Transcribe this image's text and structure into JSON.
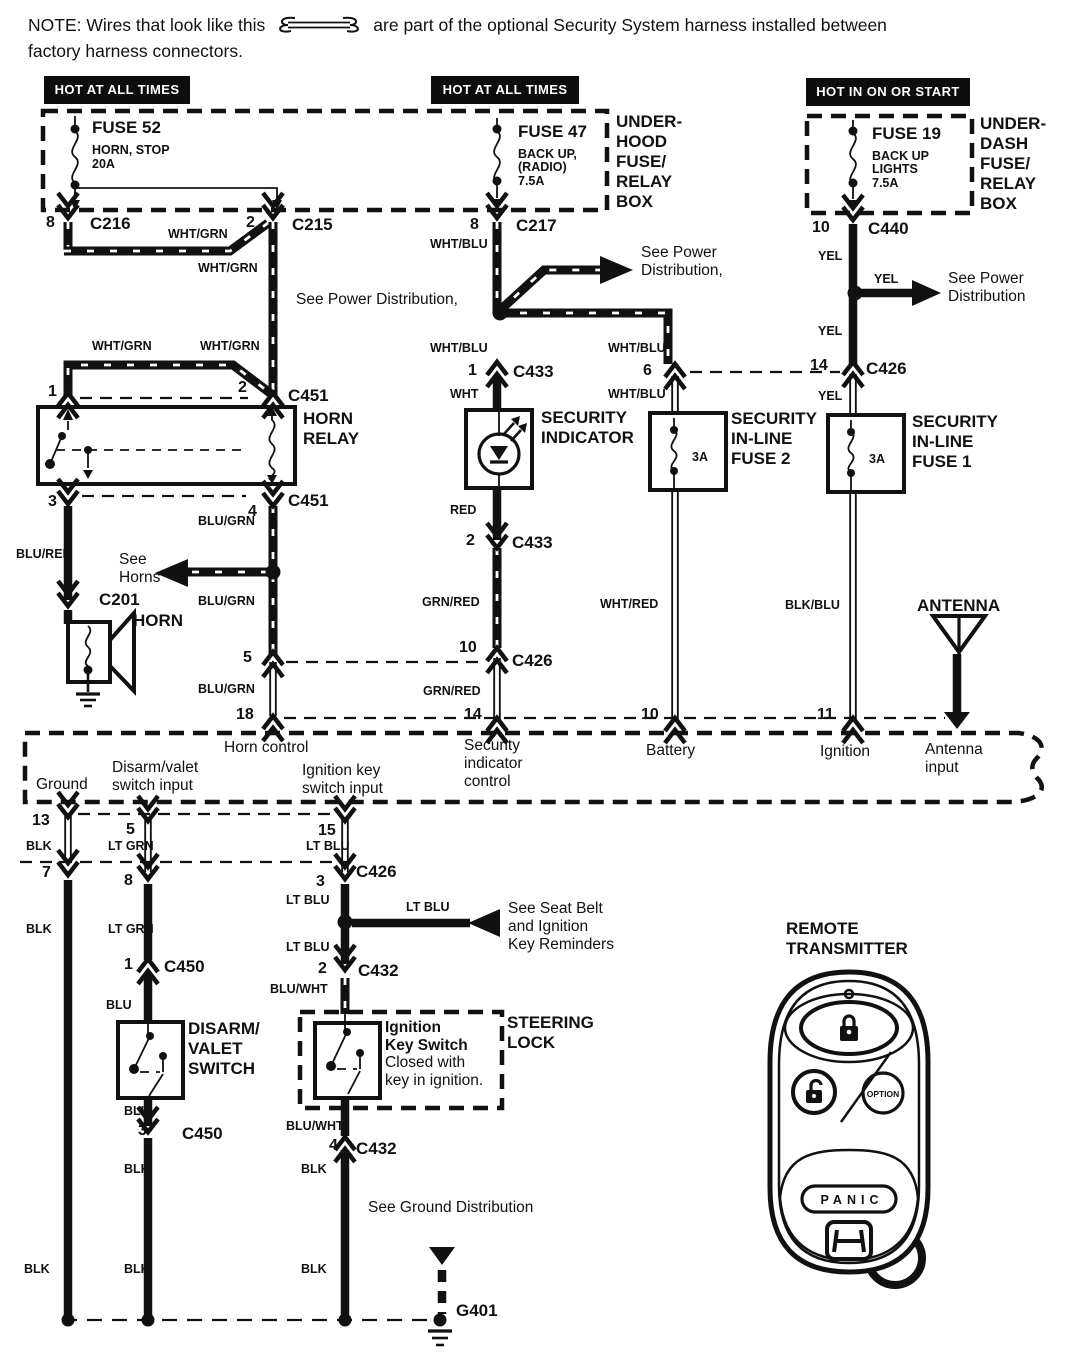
{
  "note": {
    "prefix": "NOTE: Wires that look like this",
    "suffix": "are part of the optional Security System harness installed between",
    "line2": "factory harness connectors."
  },
  "headers": {
    "left": "HOT AT ALL TIMES",
    "middle": "HOT AT ALL TIMES",
    "right": "HOT IN ON OR START"
  },
  "fuse_boxes": {
    "underhood_label": "UNDER-\nHOOD\nFUSE/\nRELAY\nBOX",
    "underdash_label": "UNDER-\nDASH\nFUSE/\nRELAY\nBOX",
    "fuse52": {
      "name": "FUSE 52",
      "desc": "HORN, STOP",
      "amp": "20A"
    },
    "fuse47": {
      "name": "FUSE 47",
      "desc1": "BACK UP,",
      "desc2": "(RADIO)",
      "amp": "7.5A"
    },
    "fuse19": {
      "name": "FUSE 19",
      "desc1": "BACK UP",
      "desc2": "LIGHTS",
      "amp": "7.5A"
    }
  },
  "components": {
    "horn_relay": "HORN\nRELAY",
    "security_indicator": "SECURITY\nINDICATOR",
    "inline_fuse2": "SECURITY\nIN-LINE\nFUSE 2",
    "inline_fuse1": "SECURITY\nIN-LINE\nFUSE 1",
    "fuse_amp_3a": "3A",
    "horn": "HORN",
    "antenna": "ANTENNA",
    "disarm_switch": "DISARM/\nVALET\nSWITCH",
    "steering_lock": "STEERING\nLOCK",
    "ignition_key_switch_title": "Ignition\nKey Switch",
    "ignition_key_switch_note": "Closed with\nkey in ignition."
  },
  "wire_colors": {
    "wht_grn": "WHT/GRN",
    "wht_blu": "WHT/BLU",
    "yel": "YEL",
    "wht": "WHT",
    "red": "RED",
    "grn_red": "GRN/RED",
    "blu_grn": "BLU/GRN",
    "blu_red": "BLU/RED",
    "wht_red": "WHT/RED",
    "blk_blu": "BLK/BLU",
    "blk": "BLK",
    "lt_grn": "LT GRN",
    "lt_blu": "LT BLU",
    "blu": "BLU",
    "blu_wht": "BLU/WHT"
  },
  "pins": {
    "n1": "1",
    "n2": "2",
    "n3": "3",
    "n4": "4",
    "n5": "5",
    "n6": "6",
    "n7": "7",
    "n8": "8",
    "n10": "10",
    "n11": "11",
    "n13": "13",
    "n14": "14",
    "n15": "15",
    "n18": "18"
  },
  "connectors": {
    "c216": "C216",
    "c215": "C215",
    "c217": "C217",
    "c440": "C440",
    "c451": "C451",
    "c433": "C433",
    "c426": "C426",
    "c201": "C201",
    "c450": "C450",
    "c432": "C432",
    "g401": "G401"
  },
  "module": {
    "horn_control": "Horn control",
    "security_indicator_control": "Security\nindicator\ncontrol",
    "battery": "Battery",
    "ignition": "Ignition",
    "antenna_input": "Antenna\ninput",
    "ground": "Ground",
    "disarm_valet_input": "Disarm/valet\nswitch input",
    "ignition_key_input": "Ignition key\nswitch input"
  },
  "refs": {
    "power_dist_comma": "See Power Distribution,",
    "power_dist_2line_comma": "See Power\nDistribution,",
    "power_dist_2line": "See Power\nDistribution",
    "see_horns": "See\nHorns",
    "seat_belt": "See Seat Belt\nand Ignition\nKey Reminders",
    "ground_dist": "See Ground Distribution"
  },
  "remote": {
    "title": "REMOTE\nTRANSMITTER",
    "panic": "PANIC",
    "option": "OPTION"
  }
}
